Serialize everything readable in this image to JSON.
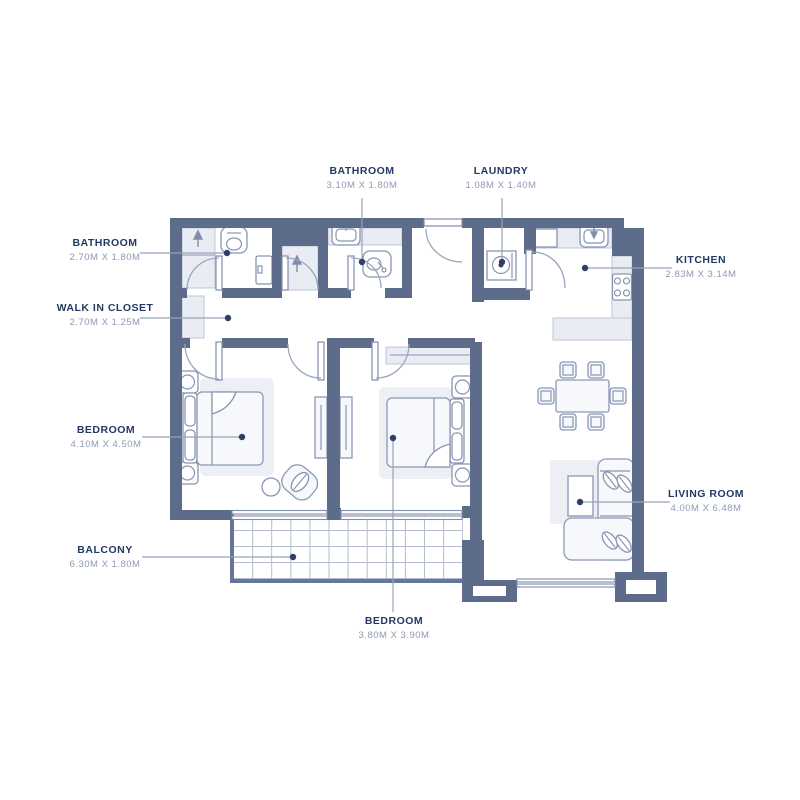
{
  "colors": {
    "wall": "#5e6c8c",
    "room_name": "#233a63",
    "room_dims": "#8e99b4",
    "leader": "#97a2ba",
    "dot": "#2e4066",
    "light_fill": "#e9ecf3",
    "background": "#ffffff"
  },
  "icons": [
    "shower-arrow-icon",
    "toilet-icon",
    "sink-icon",
    "washer-icon",
    "stove-icon",
    "bed-icon",
    "sofa-icon",
    "dining-table-icon"
  ],
  "rooms": [
    {
      "id": "bathroom-1",
      "name": "BATHROOM",
      "dims": "2.70M X 1.80M"
    },
    {
      "id": "walk-in-closet",
      "name": "WALK IN CLOSET",
      "dims": "2.70M X 1.25M"
    },
    {
      "id": "bathroom-2",
      "name": "BATHROOM",
      "dims": "3.10M X 1.80M"
    },
    {
      "id": "laundry",
      "name": "LAUNDRY",
      "dims": "1.08M X 1.40M"
    },
    {
      "id": "kitchen",
      "name": "KITCHEN",
      "dims": "2.83M X 3.14M"
    },
    {
      "id": "bedroom-1",
      "name": "BEDROOM",
      "dims": "4.10M X 4.50M"
    },
    {
      "id": "bedroom-2",
      "name": "BEDROOM",
      "dims": "3.80M X 3.90M"
    },
    {
      "id": "living-room",
      "name": "LIVING ROOM",
      "dims": "4.00M X 6.48M"
    },
    {
      "id": "balcony",
      "name": "BALCONY",
      "dims": "6.30M X 1.80M"
    }
  ]
}
